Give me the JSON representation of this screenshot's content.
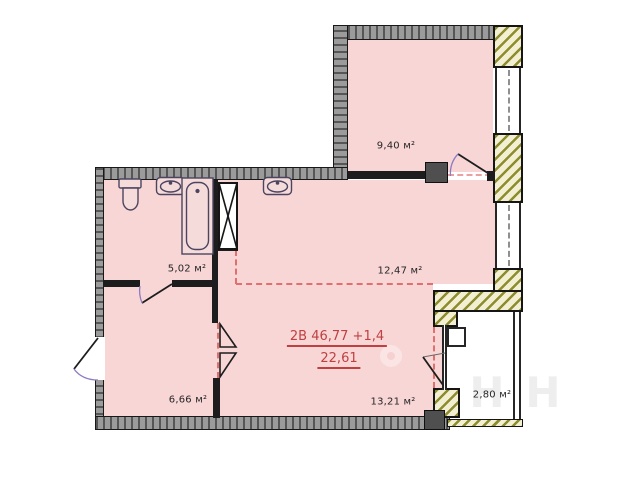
{
  "plan": {
    "type": "apartment-floor-plan",
    "unit_summary": {
      "line1": "2В  46,77 +1,4",
      "line2": "22,61"
    },
    "rooms": [
      {
        "name": "bathroom",
        "area": "5,02 м²"
      },
      {
        "name": "room-top",
        "area": "9,40 м²"
      },
      {
        "name": "hall-kitchen",
        "area": "12,47 м²"
      },
      {
        "name": "room-left",
        "area": "6,66 м²"
      },
      {
        "name": "living-room",
        "area": "13,21 м²"
      },
      {
        "name": "balcony",
        "area": "2,80 м²"
      }
    ],
    "watermark": "Н",
    "colors": {
      "room_fill": "#f8d6d6",
      "accent_red": "#bf4040",
      "dashed_red": "#e07070",
      "wall_gray": "#8c8c8c",
      "pier_hatch_stroke": "#8d8d2d",
      "pier_hatch_bg": "#f2efd2",
      "interior_wall": "#1d1d1d"
    }
  }
}
